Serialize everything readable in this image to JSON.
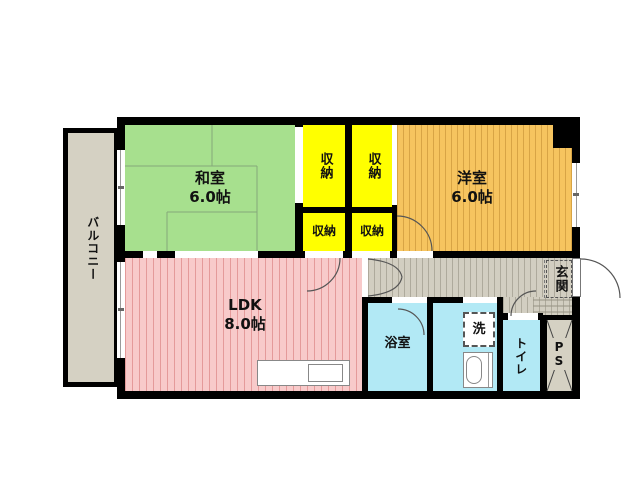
{
  "floor_plan": {
    "balcony": {
      "label": "バルコニー"
    },
    "washitsu": {
      "label": "和室\n6.0帖"
    },
    "youshitsu": {
      "label": "洋室\n6.0帖"
    },
    "ldk": {
      "label": "LDK\n8.0帖"
    },
    "storage_top_left": {
      "label": "収納"
    },
    "storage_top_right": {
      "label": "収納"
    },
    "storage_bottom_left": {
      "label": "収納"
    },
    "storage_bottom_right": {
      "label": "収納"
    },
    "bathroom": {
      "label": "浴室"
    },
    "laundry": {
      "label": "洗"
    },
    "toilet": {
      "label": "トイレ"
    },
    "entrance": {
      "label": "玄関"
    },
    "pipe_space": {
      "label": "P\nS"
    },
    "colors": {
      "wall": "#000000",
      "washitsu_green": "#a7e08e",
      "storage_yellow": "#ffff00",
      "youshitsu_orange": "#f6c45f",
      "ldk_pink": "#f8caca",
      "wet_area_cyan": "#b2e9f5",
      "balcony_gray": "#d5d1c3",
      "hallway_gray": "#d2cec1"
    }
  }
}
